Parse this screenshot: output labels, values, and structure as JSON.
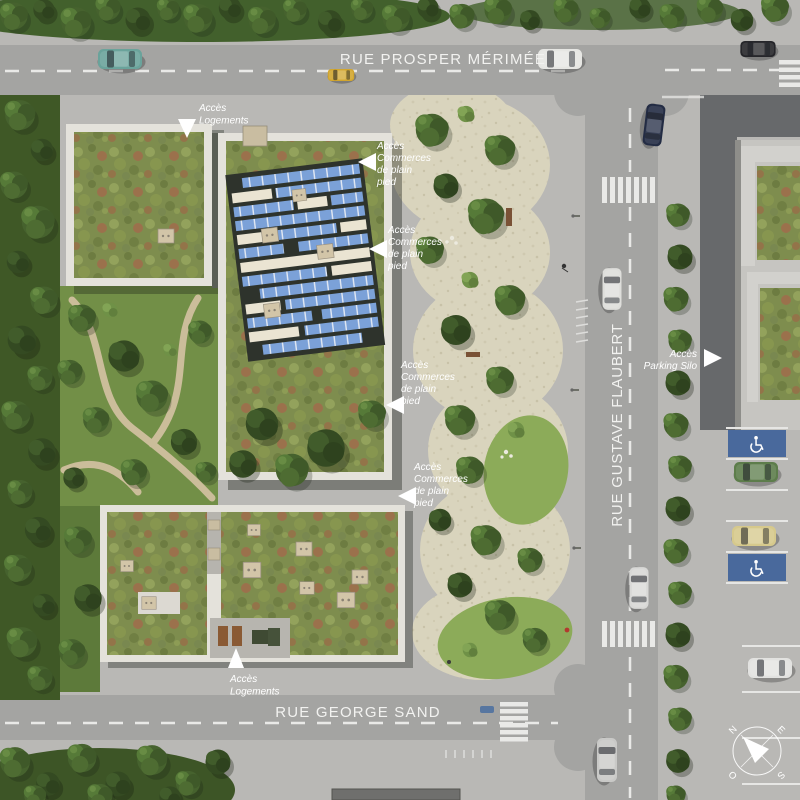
{
  "streets": {
    "prosper_merimee": "RUE PROSPER MÉRIMÉE",
    "gustave_flaubert": "RUE GUSTAVE FLAUBERT",
    "george_sand": "RUE GEORGE SAND"
  },
  "annotations": {
    "acces_logements": {
      "line1": "Accès",
      "line2": "Logements"
    },
    "acces_commerces": {
      "line1": "Accès",
      "line2": "Commerces",
      "line3": "de plain",
      "line4": "pied"
    },
    "acces_parking_silo": {
      "line1": "Accès",
      "line2": "Parking Silo"
    }
  },
  "compass": {
    "n": "N",
    "e": "E",
    "s": "S",
    "o": "O"
  },
  "colors": {
    "road": "#a4a4a2",
    "sidewalk": "#b9b8b5",
    "dark_asphalt": "#67696b",
    "gravel": "#d9d4bd",
    "sedum_roof": "#7e8d4e",
    "solar_panel": "#7ba1d8",
    "parapet": "#e4e2db",
    "accessible_blue": "#49699c",
    "road_marking": "#e9e9e7",
    "annotation_text": "#ffffff"
  }
}
